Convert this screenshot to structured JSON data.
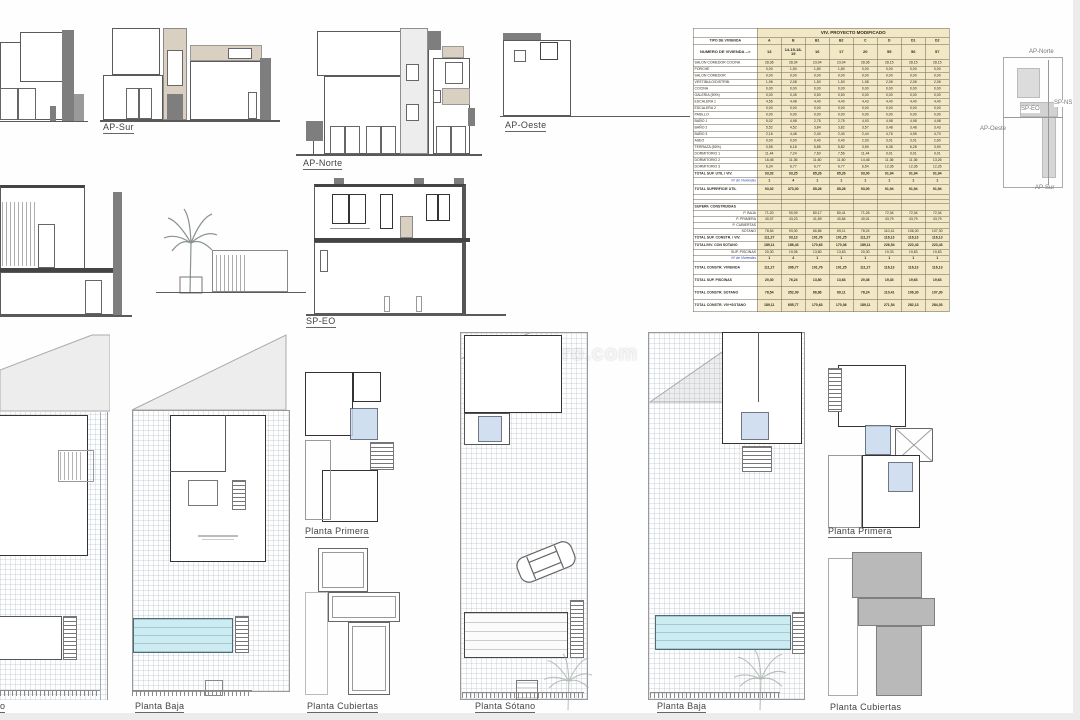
{
  "watermark": "inmo-toro.com",
  "elevations": {
    "ap_sur": "AP-Sur",
    "ap_norte": "AP-Norte",
    "ap_oeste": "AP-Oeste"
  },
  "sections": {
    "sp_eo": "SP-EO"
  },
  "plans": {
    "planta_primera_1": "Planta Primera",
    "planta_baja_1": "Planta Baja",
    "planta_cubiertas_1": "Planta Cubiertas",
    "planta_sotano": "Planta Sótano",
    "planta_baja_2": "Planta Baja",
    "planta_primera_2": "Planta Primera",
    "planta_cubiertas_2": "Planta Cubiertas",
    "fragment_left": "o"
  },
  "key_plan": {
    "ap_norte": "AP-Norte",
    "ap_oeste": "AP-Oeste",
    "ap_sur": "AP-Sur",
    "sp_eo": "SP-EO",
    "sp_ns": "SP-NS"
  },
  "colors": {
    "table_cell": "#f2e8c6",
    "pool": "#cdecf2",
    "roof_gray": "#b9b9b9",
    "garden_beige": "#cdc4ad",
    "count_blue": "#2f46b4"
  },
  "table": {
    "title": "VIV. PROYECTO MODIFICADO",
    "type_label": "TIPO DE VIVIENDA",
    "columns": [
      "A",
      "B",
      "B1",
      "B2",
      "C",
      "D",
      "D1",
      "D2"
    ],
    "number_label": "NUMERO DE VIVIENDA -->",
    "numbers": [
      "13",
      "14-15-18-19",
      "16",
      "17",
      "20",
      "55",
      "56",
      "57"
    ],
    "rows": [
      {
        "label": "SALON COMEDOR COCINA",
        "values": [
          "28,36",
          "28,34",
          "23,04",
          "23,04",
          "28,36",
          "28,15",
          "28,15",
          "28,15"
        ],
        "style": "room"
      },
      {
        "label": "PORCHE",
        "values": [
          "0,00",
          "1,50",
          "1,80",
          "1,80",
          "0,00",
          "0,00",
          "0,00",
          "0,00"
        ],
        "style": "room"
      },
      {
        "label": "SALON COMEDOR",
        "values": [
          "0,00",
          "0,00",
          "0,00",
          "0,00",
          "0,00",
          "0,00",
          "0,00",
          "0,00"
        ],
        "style": "room"
      },
      {
        "label": "VESTIBULO/DISTRIB.",
        "values": [
          "1,96",
          "2,08",
          "1,50",
          "1,50",
          "1,98",
          "2,06",
          "2,06",
          "2,06"
        ],
        "style": "room"
      },
      {
        "label": "COCINA",
        "values": [
          "0,00",
          "0,00",
          "0,00",
          "0,00",
          "0,00",
          "0,00",
          "0,00",
          "0,00"
        ],
        "style": "room"
      },
      {
        "label": "GALERIA (50%)",
        "values": [
          "0,00",
          "0,45",
          "0,50",
          "0,50",
          "0,00",
          "0,00",
          "0,00",
          "0,00"
        ],
        "style": "room"
      },
      {
        "label": "ESCALERA 1",
        "values": [
          "4,56",
          "4,48",
          "4,40",
          "4,40",
          "4,43",
          "4,40",
          "4,40",
          "4,40"
        ],
        "style": "room"
      },
      {
        "label": "ESCALERA 2",
        "values": [
          "0,00",
          "0,00",
          "0,00",
          "0,00",
          "0,00",
          "0,00",
          "0,00",
          "0,00"
        ],
        "style": "room"
      },
      {
        "label": "PASILLO",
        "values": [
          "0,00",
          "0,00",
          "0,00",
          "0,00",
          "0,00",
          "0,00",
          "0,00",
          "0,00"
        ],
        "style": "room"
      },
      {
        "label": "BAÑO 1",
        "values": [
          "5,02",
          "4,98",
          "2,75",
          "2,75",
          "4,93",
          "4,98",
          "4,98",
          "4,98"
        ],
        "style": "room"
      },
      {
        "label": "BAÑO 2",
        "values": [
          "5,52",
          "4,52",
          "3,84",
          "3,82",
          "3,57",
          "3,48",
          "3,48",
          "3,43"
        ],
        "style": "room"
      },
      {
        "label": "BAÑO 3",
        "values": [
          "2,16",
          "4,48",
          "2,40",
          "2,40",
          "2,44",
          "4,76",
          "4,95",
          "4,70"
        ],
        "style": "room"
      },
      {
        "label": "ASEO",
        "values": [
          "0,00",
          "0,00",
          "0,40",
          "0,40",
          "2,93",
          "3,01",
          "3,01",
          "2,60"
        ],
        "style": "room"
      },
      {
        "label": "TERRAZA (50%)",
        "values": [
          "0,55",
          "6,18",
          "5,85",
          "5,82",
          "3,59",
          "6,38",
          "6,28",
          "3,90"
        ],
        "style": "room"
      },
      {
        "label": "DORMITORIO 1",
        "values": [
          "11,44",
          "7,24",
          "7,60",
          "7,56",
          "11,44",
          "9,01",
          "9,01",
          "9,01"
        ],
        "style": "room"
      },
      {
        "label": "DORMITORIO 2",
        "values": [
          "16,46",
          "11,36",
          "11,60",
          "11,60",
          "14,46",
          "11,36",
          "11,36",
          "13,26"
        ],
        "style": "room"
      },
      {
        "label": "DORMITORIO 3",
        "values": [
          "6,34",
          "6,77",
          "6,77",
          "6,77",
          "6,54",
          "12,36",
          "12,36",
          "12,26"
        ],
        "style": "room"
      },
      {
        "label": "TOTAL SUP. UTIL / VIV.",
        "values": [
          "93,02",
          "93,25",
          "85,26",
          "85,26",
          "93,00",
          "91,94",
          "91,94",
          "91,94"
        ],
        "style": "total"
      },
      {
        "label": "Nº de Viviendas",
        "values": [
          "1",
          "4",
          "1",
          "1",
          "1",
          "1",
          "1",
          "1"
        ],
        "style": "count"
      },
      {
        "label": "TOTAL SUPERFICIE UTIL",
        "values": [
          "93,02",
          "373,00",
          "85,26",
          "85,26",
          "93,00",
          "91,94",
          "91,94",
          "91,94"
        ],
        "style": "totaltall"
      },
      {
        "label": "",
        "values": [
          "",
          "",
          "",
          "",
          "",
          "",
          "",
          ""
        ],
        "style": "blank"
      },
      {
        "label": "",
        "values": [
          "",
          "",
          "",
          "",
          "",
          "",
          "",
          ""
        ],
        "style": "blank"
      },
      {
        "label": "SUPERF. CONSTRUIDAS",
        "values": [
          "",
          "",
          "",
          "",
          "",
          "",
          "",
          ""
        ],
        "style": "section"
      },
      {
        "label": "P. BAJA",
        "values": [
          "71,20",
          "90,09",
          "80,17",
          "80,41",
          "71,26",
          "72,34",
          "72,34",
          "72,34"
        ],
        "style": "sub"
      },
      {
        "label": "P. PRIMERA",
        "values": [
          "40,07",
          "43,23",
          "41,59",
          "40,84",
          "40,01",
          "43,79",
          "43,79",
          "43,79"
        ],
        "style": "sub"
      },
      {
        "label": "P. CUBIERTAS",
        "values": [
          "",
          "",
          "",
          "",
          "",
          "",
          "",
          ""
        ],
        "style": "sub"
      },
      {
        "label": "SOTANO",
        "values": [
          "78,54",
          "93,30",
          "66,86",
          "69,11",
          "78,24",
          "110,41",
          "106,30",
          "107,30"
        ],
        "style": "sub"
      },
      {
        "label": "TOTAL SUP. CONSTR. / VIV.",
        "values": [
          "111,27",
          "93,13",
          "101,76",
          "101,25",
          "111,27",
          "116,13",
          "116,13",
          "116,13"
        ],
        "style": "total"
      },
      {
        "label": "TOTAL/VIV. CON SOTANO",
        "values": [
          "189,11",
          "186,43",
          "170,63",
          "170,36",
          "189,11",
          "226,54",
          "222,43",
          "223,43"
        ],
        "style": "total"
      },
      {
        "label": "SUP. PISCINAS",
        "values": [
          "20,30",
          "19,06",
          "13,80",
          "13,63",
          "20,30",
          "19,33",
          "19,63",
          "19,63"
        ],
        "style": "sub"
      },
      {
        "label": "Nº de Viviendas",
        "values": [
          "1",
          "4",
          "1",
          "1",
          "1",
          "1",
          "1",
          "1"
        ],
        "style": "count"
      },
      {
        "label": "TOTAL CONSTR. VIVIENDA",
        "values": [
          "111,27",
          "396,77",
          "101,76",
          "101,25",
          "111,27",
          "116,13",
          "116,13",
          "116,13"
        ],
        "style": "bigtotal"
      },
      {
        "label": "TOTAL SUP. PISCINAS",
        "values": [
          "20,30",
          "76,24",
          "13,80",
          "13,63",
          "20,36",
          "19,33",
          "19,63",
          "19,63"
        ],
        "style": "bigtotal"
      },
      {
        "label": "TOTAL CONSTR. SOTANO",
        "values": [
          "78,54",
          "352,09",
          "66,86",
          "69,11",
          "78,24",
          "110,41",
          "106,30",
          "107,30"
        ],
        "style": "bigtotal"
      },
      {
        "label": "TOTAL CONSTR. VIV+SOTANO",
        "values": [
          "189,11",
          "655,77",
          "170,63",
          "170,36",
          "189,11",
          "271,54",
          "282,13",
          "284,03"
        ],
        "style": "bigtotal"
      }
    ]
  }
}
